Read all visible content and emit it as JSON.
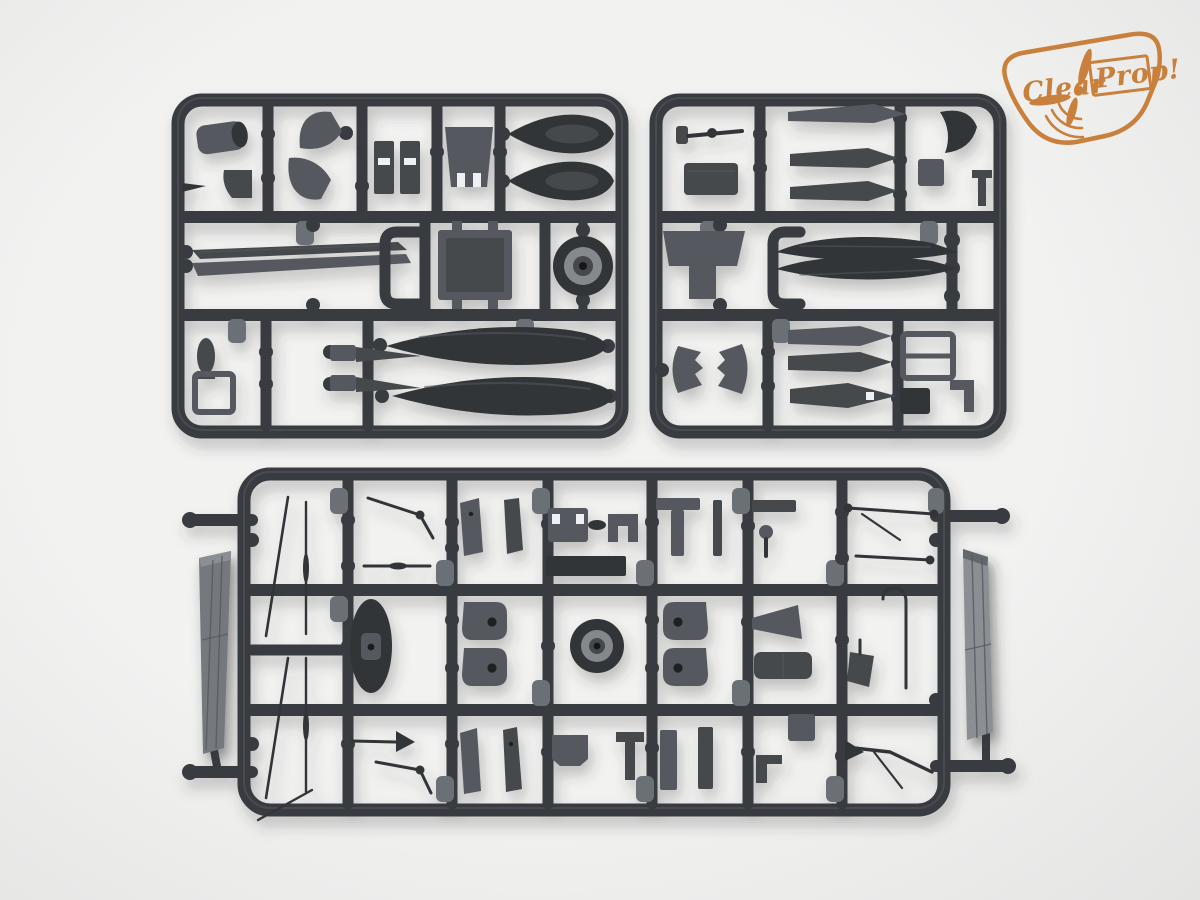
{
  "colors": {
    "bg": "#f2f2f1",
    "bg-edge": "#e4e4e3",
    "frame": "#383b3f",
    "frame-hi": "#565a5f",
    "part": "#56595e",
    "part-dark": "#45484c",
    "part-deep": "#323539",
    "hole": "#eef0f1",
    "tab": "#6b6f74",
    "slab": "#74787d",
    "slab-light": "#8b8f94",
    "logo": "#c9803c",
    "shadow": "#3a3a3a"
  },
  "logo": {
    "word1": "Clear",
    "word2": "Prop!"
  },
  "sprues": [
    {
      "id": "sprue-top-left"
    },
    {
      "id": "sprue-top-right"
    },
    {
      "id": "sprue-bottom"
    }
  ]
}
